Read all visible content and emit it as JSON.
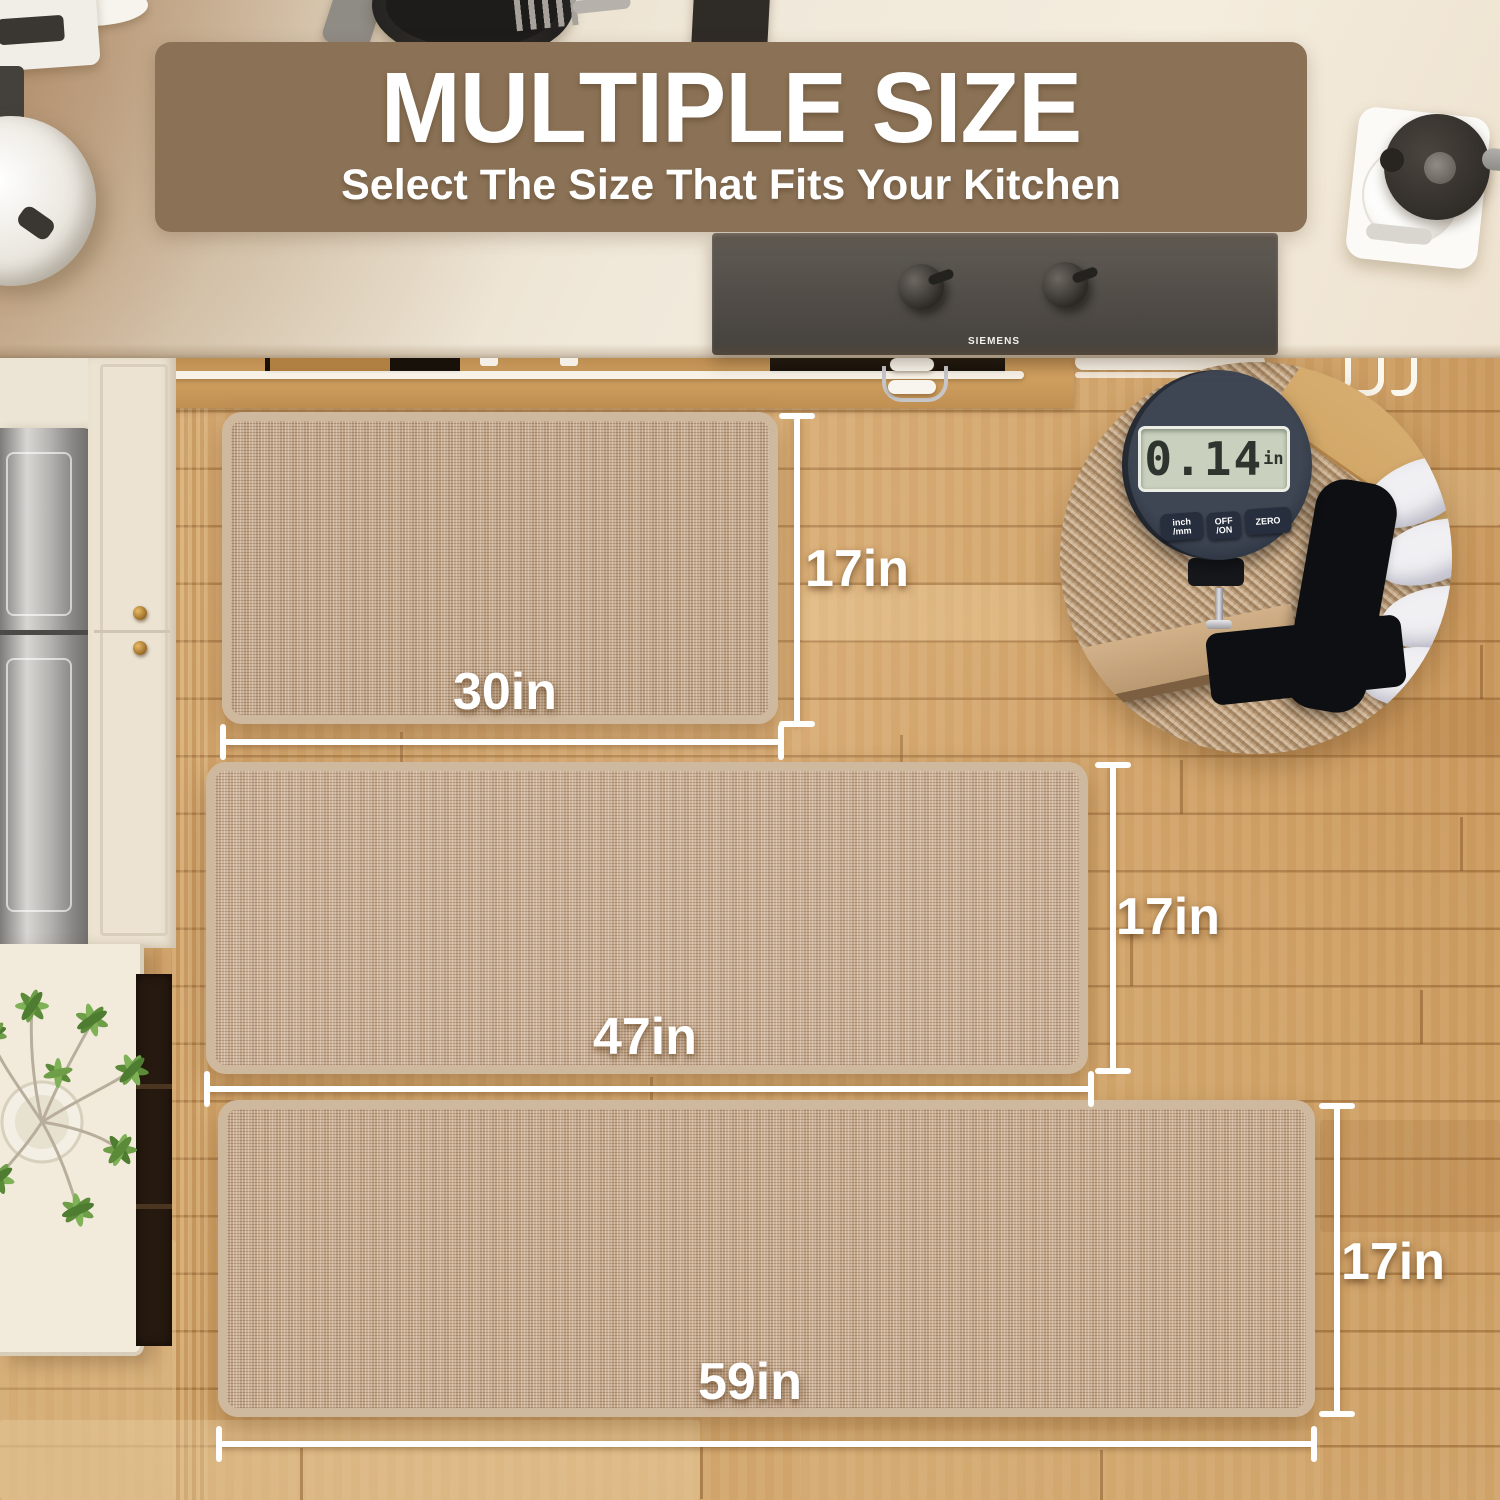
{
  "banner": {
    "title": "MULTIPLE SIZE",
    "subtitle": "Select The Size That Fits Your Kitchen",
    "bg_color": "#8b7256",
    "text_color": "#ffffff"
  },
  "mats": [
    {
      "id": "mat-small",
      "width_label": "30in",
      "height_label": "17in"
    },
    {
      "id": "mat-medium",
      "width_label": "47in",
      "height_label": "17in"
    },
    {
      "id": "mat-large",
      "width_label": "59in",
      "height_label": "17in"
    }
  ],
  "inset": {
    "reading": "0.14",
    "unit": "in",
    "buttons": [
      {
        "line1": "inch",
        "line2": "/mm"
      },
      {
        "line1": "OFF",
        "line2": "/ON"
      },
      {
        "line1": "ZERO",
        "line2": ""
      }
    ]
  },
  "hood": {
    "brand": "SIEMENS"
  },
  "colors": {
    "banner": "#8b7256",
    "mat_weave": "#c1a384",
    "mat_binding": "#cfb99e",
    "floor_wood": "#d9a867",
    "dimension_lines": "#ffffff",
    "lcd_screen": "#c9d0bd",
    "hood_gray": "#514c47"
  }
}
